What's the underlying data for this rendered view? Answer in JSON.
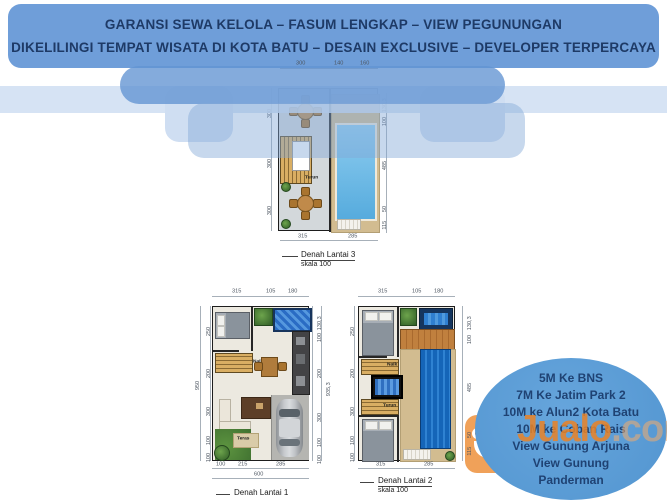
{
  "banner": {
    "line1": "GARANSI SEWA KELOLA – FASUM LENGKAP – VIEW PEGUNUNGAN",
    "line2": "DIKELILINGI TEMPAT WISATA DI KOTA BATU – DESAIN EXCLUSIVE – DEVELOPER TERPERCAYA"
  },
  "plans": {
    "lantai3": {
      "title": "Denah Lantai 3",
      "scale": "skala 100",
      "dims_top": [
        "300",
        "140",
        "160"
      ],
      "dims_left": [
        "300",
        "300",
        "300"
      ],
      "dims_right": [
        "130,3",
        "100",
        "485",
        "50",
        "115"
      ],
      "dims_bottom": [
        "315",
        "285"
      ],
      "stair_label": "Turun"
    },
    "lantai1": {
      "title": "Denah Lantai 1",
      "dims_top": [
        "315",
        "105",
        "180"
      ],
      "dims_left": [
        "250",
        "200",
        "300",
        "100",
        "100"
      ],
      "dims_left_total": "950",
      "dims_right": [
        "130,3",
        "100",
        "200",
        "300",
        "100",
        "100"
      ],
      "dims_right_total": "935,3",
      "dims_bottom": [
        "100",
        "215",
        "285"
      ],
      "dims_bottom_total": "600",
      "stair_label": "Naik",
      "teras_label": "Teras"
    },
    "lantai2": {
      "title": "Denah Lantai 2",
      "scale": "skala 100",
      "dims_top": [
        "315",
        "105",
        "180"
      ],
      "dims_left": [
        "250",
        "200",
        "300",
        "100",
        "100"
      ],
      "dims_right": [
        "130,3",
        "100",
        "485",
        "50",
        "115"
      ],
      "dims_bottom": [
        "315",
        "285"
      ],
      "stair_up_label": "Naik",
      "stair_down_label": "Turun"
    }
  },
  "callout": {
    "lines": [
      "5M Ke BNS",
      "7M Ke Jatim Park 2",
      "10M ke Alun2 Kota Batu",
      "10M ke Coban Rais",
      "View Gunung Arjuna",
      "View Gunung",
      "Panderman"
    ]
  },
  "watermark": {
    "brand": "Jualo",
    "tld": ".com"
  },
  "colors": {
    "banner_blue": "#6f9ed9",
    "banner_text": "#1e3a66",
    "pale_blue": "#cfdef2",
    "callout_blue": "#5b9bd5",
    "watermark_orange": "#ec8a30",
    "pool_light": "#6fbce8",
    "pool_deep": "#1e6cbe",
    "deck_tan": "#d2bc90"
  }
}
